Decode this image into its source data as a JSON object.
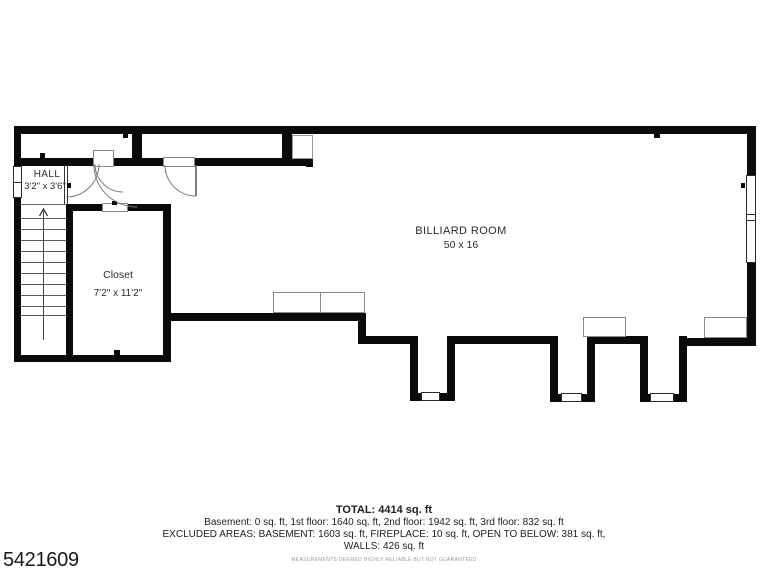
{
  "listing_id": "5421609",
  "colors": {
    "wall": "#0a0a0a",
    "text": "#2b2b2b",
    "muted": "#999999"
  },
  "rooms": {
    "hall": {
      "name": "HALL",
      "dims": "3'2\" x 3'6\""
    },
    "closet": {
      "name": "Closet",
      "dims": "7'2\" x 11'2\""
    },
    "billiard": {
      "name": "BILLIARD ROOM",
      "dims": "50 x 16"
    }
  },
  "summary": {
    "total": "TOTAL: 4414 sq. ft",
    "floors": "Basement: 0 sq. ft, 1st floor: 1640 sq. ft, 2nd floor: 1942 sq. ft, 3rd floor: 832 sq. ft",
    "excluded": "EXCLUDED AREAS: BASEMENT: 1603 sq. ft, FIREPLACE: 10 sq. ft, OPEN TO BELOW: 381 sq. ft,",
    "walls": "WALLS: 426 sq. ft",
    "disclaimer": "MEASUREMENTS DEEMED HIGHLY RELIABLE BUT NOT GUARANTEED"
  }
}
